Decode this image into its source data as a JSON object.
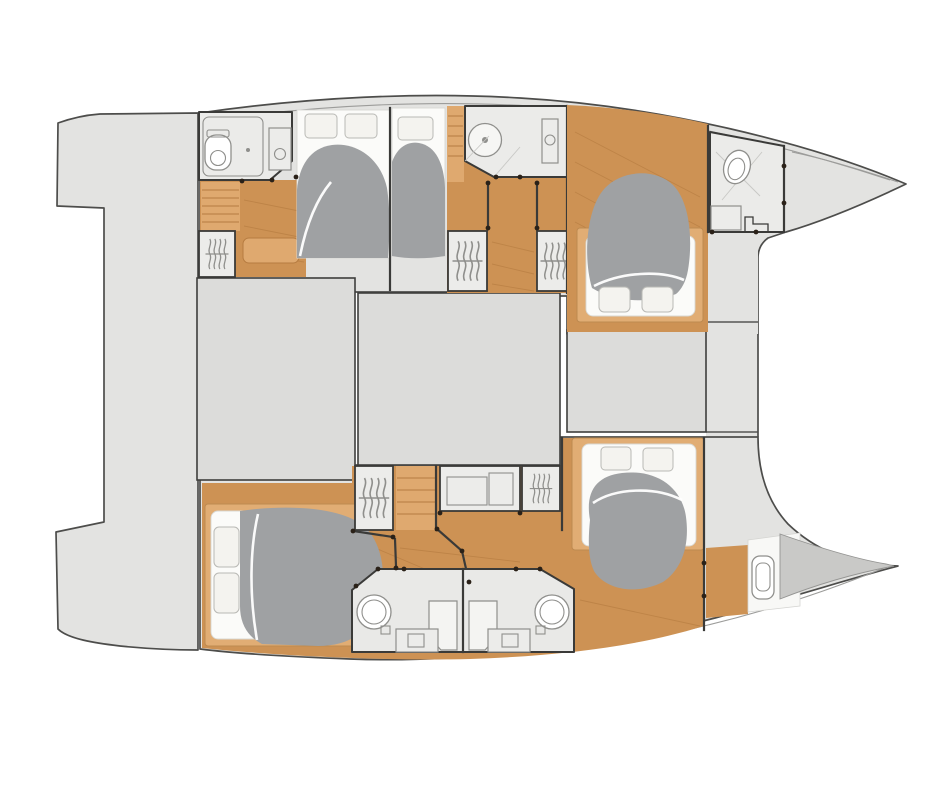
{
  "meta": {
    "kind": "catamaran-yacht-interior-deck-plan",
    "orientation": "bow-right",
    "visible_text": []
  },
  "colors": {
    "page_bg": "#ffffff",
    "deck": "#e3e3e1",
    "deck_stroke": "#4d4d4b",
    "interior": "#ebebe9",
    "bridge": "#dcdcda",
    "bridge_stroke": "#3e3e3c",
    "wood": "#cd9254",
    "wood_light": "#dfa96f",
    "wood_line": "#b67c41",
    "frame": "#e1ad74",
    "frame_stroke": "#bd8a50",
    "duvet": "#9fa1a3",
    "linen": "#fbfbf9",
    "pillow": "#f4f3ef",
    "pillow_stroke": "#b9b9b5",
    "fixture": "#8f8f8c",
    "wall": "#3a3a38",
    "dot": "#2a2118",
    "forepeak": "#c9c9c7",
    "sheer": "#9c9c9a",
    "module": "#e9e9e7"
  },
  "icons": {
    "wardrobe": "hanging-clothes-squiggles",
    "toilet": "oval-toilet",
    "shower": "round-shower-enclosure",
    "sink": "circle-sink",
    "bed": "double-berth-with-gray-duvet",
    "stairs": "companionway-steps",
    "door_pivot": "dark-dot"
  },
  "inventory": {
    "hulls": 2,
    "cabins": 5,
    "double_berths": 5,
    "wet_rooms": 6,
    "wardrobes": 5,
    "desk_units": 1,
    "companionway_stairs": 3,
    "saloon_deck_blocks": 2,
    "foredeck_blocks": 1,
    "stern_platform": 1
  }
}
